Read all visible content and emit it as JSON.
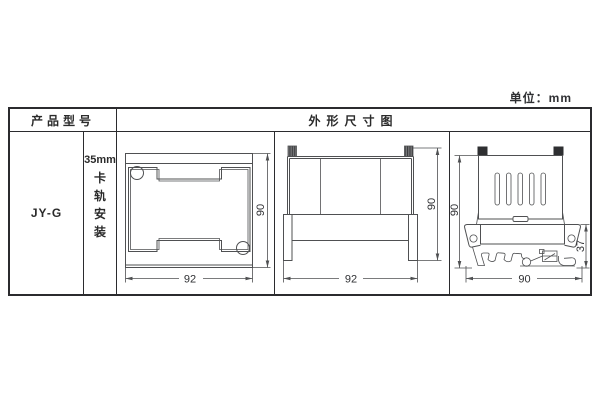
{
  "unit_label": "单位：mm",
  "table": {
    "headers": {
      "product_model": "产品型号",
      "outline_drawing": "外形尺寸图"
    },
    "product_model": "JY-G",
    "mounting": {
      "size": "35mm",
      "chars": [
        "卡",
        "轨",
        "安",
        "装"
      ]
    }
  },
  "drawings": {
    "front": {
      "width": "92",
      "height": "90"
    },
    "side": {
      "width": "92",
      "height": "90"
    },
    "rail": {
      "width": "90",
      "height": "90",
      "clip_height": "37"
    }
  },
  "colors": {
    "line": "#4f5052",
    "border": "#2b2b2e",
    "text": "#2f3033"
  }
}
